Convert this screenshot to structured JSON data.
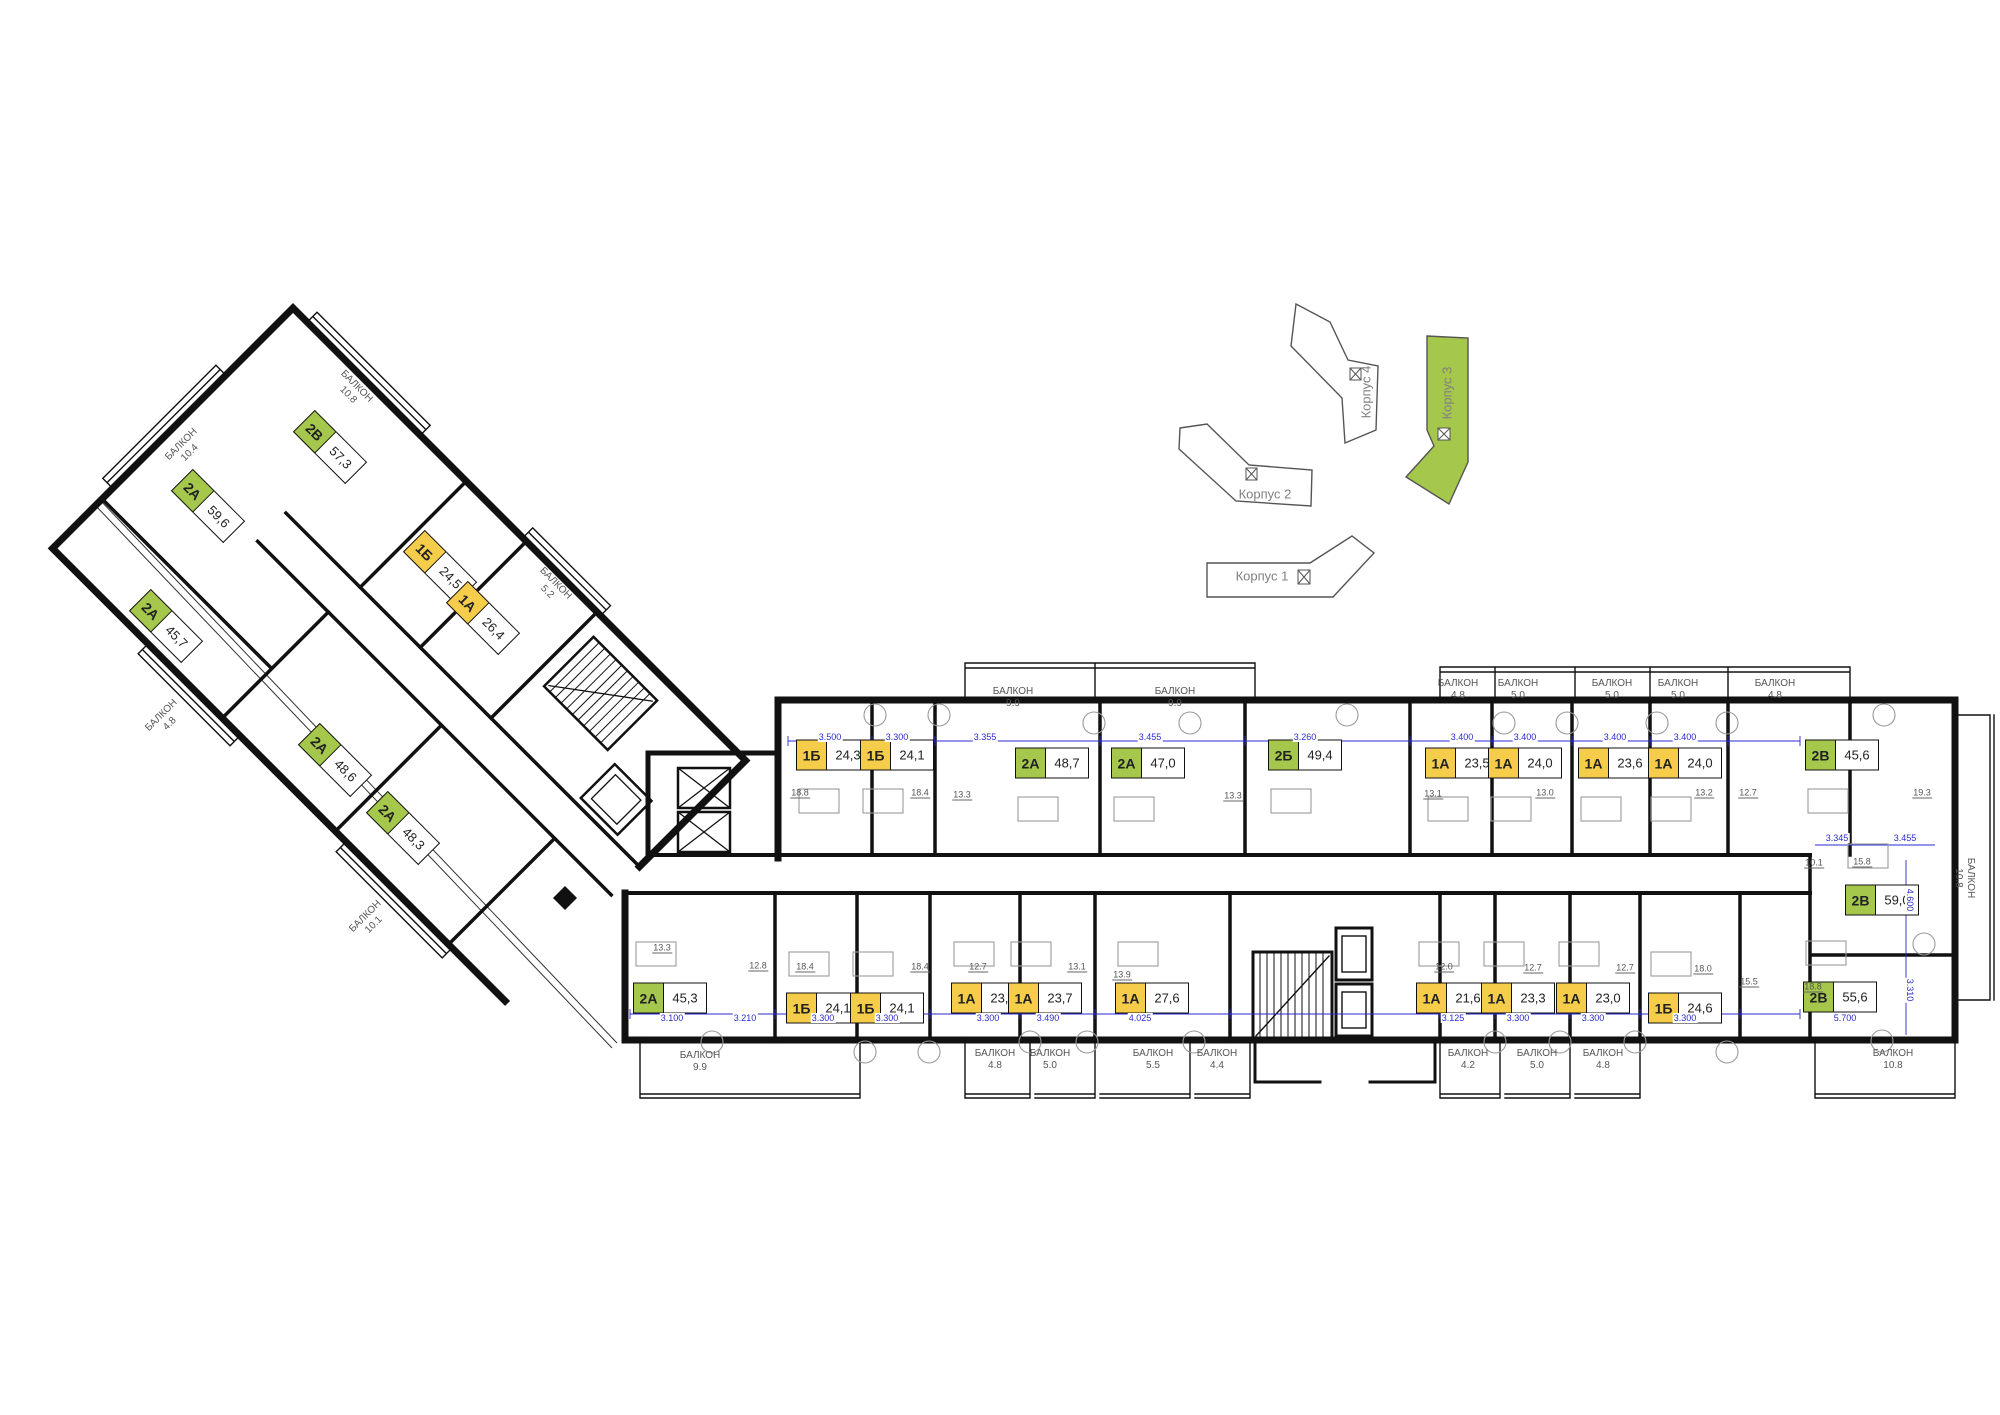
{
  "colors": {
    "type1_yellow": "#f6cd4b",
    "type2_green": "#a5c74c",
    "wall": "#111111",
    "dim_blue": "#2a2ad0",
    "minimap_stroke": "#555555"
  },
  "balcony_word": "БАЛКОН",
  "minimap": {
    "buildings": [
      {
        "id": "korpus-1",
        "label": "Корпус 1",
        "highlighted": false,
        "lx": 1262,
        "ly": 576,
        "lr": 0
      },
      {
        "id": "korpus-2",
        "label": "Корпус 2",
        "highlighted": false,
        "lx": 1265,
        "ly": 494,
        "lr": 0
      },
      {
        "id": "korpus-4",
        "label": "Корпус 4",
        "highlighted": false,
        "lx": 1366,
        "ly": 392,
        "lr": -90
      },
      {
        "id": "korpus-3",
        "label": "Корпус 3",
        "highlighted": true,
        "lx": 1447,
        "ly": 393,
        "lr": -90
      }
    ]
  },
  "units": [
    {
      "t": "1Б",
      "a": "24,3",
      "x": 833,
      "y": 755,
      "r": 0
    },
    {
      "t": "1Б",
      "a": "24,1",
      "x": 897,
      "y": 755,
      "r": 0
    },
    {
      "t": "2А",
      "a": "48,7",
      "x": 1052,
      "y": 763,
      "r": 0
    },
    {
      "t": "2А",
      "a": "47,0",
      "x": 1148,
      "y": 763,
      "r": 0
    },
    {
      "t": "2Б",
      "a": "49,4",
      "x": 1305,
      "y": 755,
      "r": 0
    },
    {
      "t": "1А",
      "a": "23,5",
      "x": 1462,
      "y": 763,
      "r": 0
    },
    {
      "t": "1А",
      "a": "24,0",
      "x": 1525,
      "y": 763,
      "r": 0
    },
    {
      "t": "1А",
      "a": "23,6",
      "x": 1615,
      "y": 763,
      "r": 0
    },
    {
      "t": "1А",
      "a": "24,0",
      "x": 1685,
      "y": 763,
      "r": 0
    },
    {
      "t": "2В",
      "a": "45,6",
      "x": 1842,
      "y": 755,
      "r": 0
    },
    {
      "t": "2А",
      "a": "45,3",
      "x": 670,
      "y": 998,
      "r": 0
    },
    {
      "t": "1Б",
      "a": "24,1",
      "x": 823,
      "y": 1008,
      "r": 0
    },
    {
      "t": "1Б",
      "a": "24,1",
      "x": 887,
      "y": 1008,
      "r": 0
    },
    {
      "t": "1А",
      "a": "23,3",
      "x": 988,
      "y": 998,
      "r": 0
    },
    {
      "t": "1А",
      "a": "23,7",
      "x": 1045,
      "y": 998,
      "r": 0
    },
    {
      "t": "1А",
      "a": "27,6",
      "x": 1152,
      "y": 998,
      "r": 0
    },
    {
      "t": "1А",
      "a": "21,6",
      "x": 1453,
      "y": 998,
      "r": 0
    },
    {
      "t": "1А",
      "a": "23,3",
      "x": 1518,
      "y": 998,
      "r": 0
    },
    {
      "t": "1А",
      "a": "23,0",
      "x": 1593,
      "y": 998,
      "r": 0
    },
    {
      "t": "1Б",
      "a": "24,6",
      "x": 1685,
      "y": 1008,
      "r": 0
    },
    {
      "t": "2В",
      "a": "55,6",
      "x": 1840,
      "y": 997,
      "r": 0
    },
    {
      "t": "2В",
      "a": "59,0",
      "x": 1882,
      "y": 900,
      "r": 0
    },
    {
      "t": "2В",
      "a": "57,3",
      "x": 330,
      "y": 447,
      "r": 45
    },
    {
      "t": "2А",
      "a": "59,6",
      "x": 208,
      "y": 506,
      "r": 45
    },
    {
      "t": "1Б",
      "a": "24,5",
      "x": 440,
      "y": 567,
      "r": 45
    },
    {
      "t": "1А",
      "a": "26,4",
      "x": 483,
      "y": 618,
      "r": 45
    },
    {
      "t": "2А",
      "a": "45,7",
      "x": 166,
      "y": 626,
      "r": 45
    },
    {
      "t": "2А",
      "a": "48,6",
      "x": 335,
      "y": 760,
      "r": 45
    },
    {
      "t": "2А",
      "a": "48,3",
      "x": 403,
      "y": 828,
      "r": 45
    }
  ],
  "balconies": [
    {
      "a": "9.9",
      "x": 1013,
      "y": 698,
      "r": 0
    },
    {
      "a": "9.9",
      "x": 1175,
      "y": 698,
      "r": 0
    },
    {
      "a": "4.8",
      "x": 1458,
      "y": 690,
      "r": 0
    },
    {
      "a": "5.0",
      "x": 1518,
      "y": 690,
      "r": 0
    },
    {
      "a": "5.0",
      "x": 1612,
      "y": 690,
      "r": 0
    },
    {
      "a": "5.0",
      "x": 1678,
      "y": 690,
      "r": 0
    },
    {
      "a": "4.8",
      "x": 1775,
      "y": 690,
      "r": 0
    },
    {
      "a": "9.9",
      "x": 700,
      "y": 1062,
      "r": 0
    },
    {
      "a": "4.8",
      "x": 995,
      "y": 1060,
      "r": 0
    },
    {
      "a": "5.0",
      "x": 1050,
      "y": 1060,
      "r": 0
    },
    {
      "a": "5.5",
      "x": 1153,
      "y": 1060,
      "r": 0
    },
    {
      "a": "4.4",
      "x": 1217,
      "y": 1060,
      "r": 0
    },
    {
      "a": "4.2",
      "x": 1468,
      "y": 1060,
      "r": 0
    },
    {
      "a": "5.0",
      "x": 1537,
      "y": 1060,
      "r": 0
    },
    {
      "a": "4.8",
      "x": 1603,
      "y": 1060,
      "r": 0
    },
    {
      "a": "10.8",
      "x": 1893,
      "y": 1060,
      "r": 0
    },
    {
      "a": "10.8",
      "x": 1964,
      "y": 878,
      "r": 90
    },
    {
      "a": "10.4",
      "x": 186,
      "y": 449,
      "r": -45
    },
    {
      "a": "10.8",
      "x": 352,
      "y": 391,
      "r": 45
    },
    {
      "a": "5.2",
      "x": 551,
      "y": 588,
      "r": 45
    },
    {
      "a": "4.8",
      "x": 166,
      "y": 720,
      "r": -45
    },
    {
      "a": "10.1",
      "x": 370,
      "y": 921,
      "r": -45
    }
  ],
  "room_areas": [
    {
      "v": "18.8",
      "x": 800,
      "y": 793
    },
    {
      "v": "18.4",
      "x": 920,
      "y": 793
    },
    {
      "v": "13.3",
      "x": 962,
      "y": 795
    },
    {
      "v": "13.3",
      "x": 1233,
      "y": 796
    },
    {
      "v": "13.1",
      "x": 1433,
      "y": 794
    },
    {
      "v": "13.0",
      "x": 1545,
      "y": 793
    },
    {
      "v": "13.2",
      "x": 1704,
      "y": 793
    },
    {
      "v": "12.7",
      "x": 1748,
      "y": 793
    },
    {
      "v": "19.3",
      "x": 1922,
      "y": 793
    },
    {
      "v": "13.3",
      "x": 662,
      "y": 948
    },
    {
      "v": "12.8",
      "x": 758,
      "y": 966
    },
    {
      "v": "18.4",
      "x": 805,
      "y": 967
    },
    {
      "v": "18.4",
      "x": 920,
      "y": 967
    },
    {
      "v": "12.7",
      "x": 978,
      "y": 967
    },
    {
      "v": "13.1",
      "x": 1077,
      "y": 967
    },
    {
      "v": "13.9",
      "x": 1122,
      "y": 975
    },
    {
      "v": "12.0",
      "x": 1444,
      "y": 967
    },
    {
      "v": "12.7",
      "x": 1533,
      "y": 968
    },
    {
      "v": "12.7",
      "x": 1625,
      "y": 968
    },
    {
      "v": "18.0",
      "x": 1703,
      "y": 969
    },
    {
      "v": "15.5",
      "x": 1749,
      "y": 982
    },
    {
      "v": "18.8",
      "x": 1813,
      "y": 987
    },
    {
      "v": "15.8",
      "x": 1862,
      "y": 862
    },
    {
      "v": "10.1",
      "x": 1814,
      "y": 863
    }
  ],
  "dimensions": [
    {
      "v": "3.500",
      "x": 830,
      "y": 737,
      "r": 0
    },
    {
      "v": "3.300",
      "x": 897,
      "y": 737,
      "r": 0
    },
    {
      "v": "3.355",
      "x": 985,
      "y": 737,
      "r": 0
    },
    {
      "v": "3.455",
      "x": 1150,
      "y": 737,
      "r": 0
    },
    {
      "v": "3.260",
      "x": 1305,
      "y": 737,
      "r": 0
    },
    {
      "v": "3.400",
      "x": 1462,
      "y": 737,
      "r": 0
    },
    {
      "v": "3.400",
      "x": 1525,
      "y": 737,
      "r": 0
    },
    {
      "v": "3.400",
      "x": 1615,
      "y": 737,
      "r": 0
    },
    {
      "v": "3.400",
      "x": 1685,
      "y": 737,
      "r": 0
    },
    {
      "v": "3.345",
      "x": 1837,
      "y": 838,
      "r": 0
    },
    {
      "v": "3.455",
      "x": 1905,
      "y": 838,
      "r": 0
    },
    {
      "v": "3.100",
      "x": 672,
      "y": 1018,
      "r": 0
    },
    {
      "v": "3.210",
      "x": 745,
      "y": 1018,
      "r": 0
    },
    {
      "v": "3.300",
      "x": 823,
      "y": 1018,
      "r": 0
    },
    {
      "v": "3.300",
      "x": 887,
      "y": 1018,
      "r": 0
    },
    {
      "v": "3.300",
      "x": 988,
      "y": 1018,
      "r": 0
    },
    {
      "v": "3.490",
      "x": 1048,
      "y": 1018,
      "r": 0
    },
    {
      "v": "4.025",
      "x": 1140,
      "y": 1018,
      "r": 0
    },
    {
      "v": "3.125",
      "x": 1453,
      "y": 1018,
      "r": 0
    },
    {
      "v": "3.300",
      "x": 1518,
      "y": 1018,
      "r": 0
    },
    {
      "v": "3.300",
      "x": 1593,
      "y": 1018,
      "r": 0
    },
    {
      "v": "3.300",
      "x": 1685,
      "y": 1018,
      "r": 0
    },
    {
      "v": "5.700",
      "x": 1845,
      "y": 1018,
      "r": 0
    },
    {
      "v": "4.600",
      "x": 1910,
      "y": 900,
      "r": 90
    },
    {
      "v": "3.310",
      "x": 1910,
      "y": 990,
      "r": 90
    }
  ]
}
